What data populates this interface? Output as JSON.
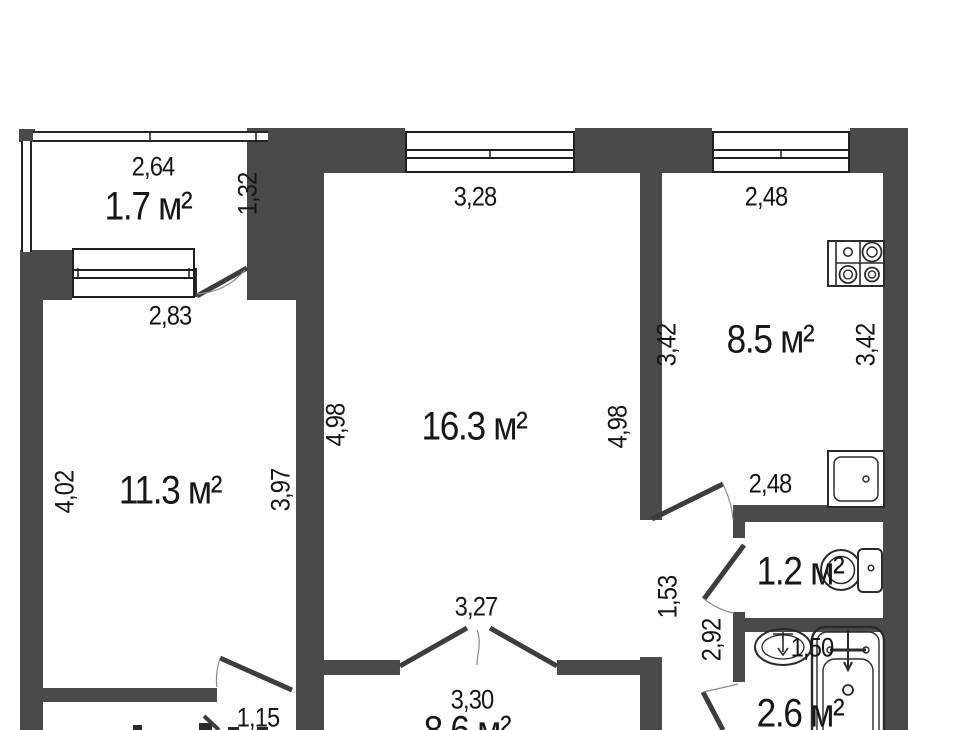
{
  "floorplan": {
    "wall_color": "#4a4a4a",
    "line_color": "#1f1f1f",
    "areas": {
      "balcony": "1.7 м²",
      "room_left": "11.3 м²",
      "room_center": "16.3 м²",
      "kitchen": "8.5 м²",
      "wc": "1.2 м²",
      "bathroom": "2.6 м²",
      "hall": "8.6 м²"
    },
    "dims": {
      "balcony_width": "2,64",
      "balcony_depth": "1,32",
      "room_left_window": "2,83",
      "room_center_window": "3,28",
      "kitchen_top": "2,48",
      "kitchen_side_left": "3,42",
      "kitchen_side_right": "3,42",
      "room_center_left": "4,98",
      "room_center_right": "4,98",
      "room_left_side_left": "4,02",
      "room_left_side_right": "3,97",
      "kitchen_bottom": "2,48",
      "corridor_upper": "1,53",
      "corridor_lower": "2,92",
      "bathroom_width": "1,50",
      "room_center_doorway": "3,27",
      "hall_width": "3,30",
      "room_left_doorway": "1,15"
    },
    "fixtures": [
      "stove-icon",
      "sink-icon",
      "toilet-icon",
      "basin-icon",
      "bathtub-icon"
    ]
  }
}
